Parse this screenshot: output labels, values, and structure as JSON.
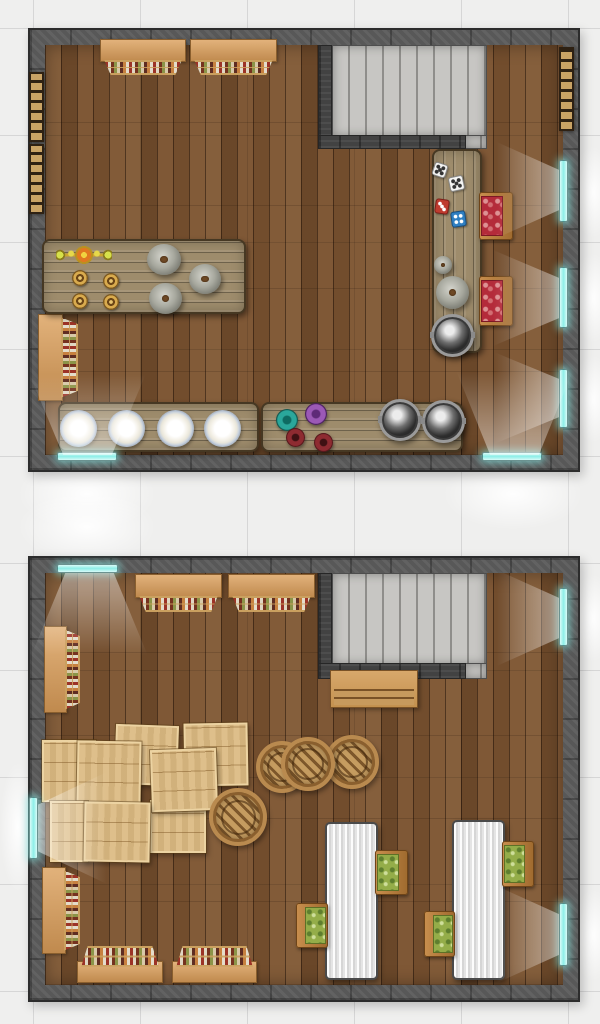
{
  "meta": {
    "canvas_width": 600,
    "canvas_height": 1024,
    "grid_size": 107,
    "grid_offset_x": 33,
    "grid_offset_y": 28
  },
  "palette": {
    "c-bg": "#efefee",
    "c-grid": "#d6d6d6",
    "c-wall": "#585858",
    "c-wall-dark": "#2c2c2c",
    "c-floor": "#7b5330",
    "c-window": "#8deee8",
    "c-wood-light": "#dcba82",
    "c-table-gray": "#9e8c6c",
    "c-table-white": "#e8e8e8",
    "c-cushion-red": "#b42b3a",
    "c-cushion-green": "#94ad49",
    "c-stairs-light": "#c7c6c3",
    "c-stairs-dark": "#8f8e8b"
  },
  "items": [
    {
      "name": "window-glow",
      "type": "glow",
      "x": 18,
      "y": 458,
      "w": 138,
      "h": 72
    },
    {
      "name": "window-glow",
      "type": "glow",
      "x": 443,
      "y": 458,
      "w": 140,
      "h": 72
    },
    {
      "name": "window-glow",
      "type": "glow",
      "x": 572,
      "y": 146,
      "w": 42,
      "h": 92
    },
    {
      "name": "window-glow",
      "type": "glow",
      "x": 572,
      "y": 253,
      "w": 42,
      "h": 90
    },
    {
      "name": "window-glow",
      "type": "glow",
      "x": 572,
      "y": 355,
      "w": 42,
      "h": 88
    },
    {
      "name": "window-glow",
      "type": "glow",
      "x": 18,
      "y": 492,
      "w": 138,
      "h": 70
    },
    {
      "name": "window-glow",
      "type": "glow",
      "x": 0,
      "y": 762,
      "w": 36,
      "h": 130
    },
    {
      "name": "window-glow",
      "type": "glow",
      "x": 572,
      "y": 574,
      "w": 42,
      "h": 88
    },
    {
      "name": "window-glow",
      "type": "glow",
      "x": 572,
      "y": 889,
      "w": 42,
      "h": 92
    },
    {
      "name": "kitchen-room-wall",
      "type": "room",
      "x": 28,
      "y": 28,
      "w": 552,
      "h": 444
    },
    {
      "name": "kitchen-floor",
      "type": "floor",
      "x": 45,
      "y": 45,
      "w": 518,
      "h": 410
    },
    {
      "name": "staircase",
      "type": "stairs",
      "x": 332,
      "y": 45,
      "w": 155,
      "h": 92
    },
    {
      "name": "staircase-landing",
      "type": "stairs",
      "x": 464,
      "y": 135,
      "w": 23,
      "h": 14
    },
    {
      "name": "stairwell-wall",
      "type": "stairwall",
      "x": 318,
      "y": 45,
      "w": 14,
      "h": 104
    },
    {
      "name": "stairwell-wall",
      "type": "stairwall",
      "x": 318,
      "y": 135,
      "w": 148,
      "h": 14
    },
    {
      "name": "hanging-shelf",
      "type": "shelf",
      "v": "o-top",
      "x": 100,
      "y": 39,
      "w": 86,
      "h": 36
    },
    {
      "name": "hanging-shelf",
      "type": "shelf",
      "v": "o-top",
      "x": 190,
      "y": 39,
      "w": 87,
      "h": 36
    },
    {
      "name": "wall-shelf",
      "type": "shelf",
      "v": "o-left",
      "x": 38,
      "y": 314,
      "w": 40,
      "h": 87
    },
    {
      "name": "wall-ladder",
      "type": "ladder",
      "x": 29,
      "y": 72,
      "w": 15,
      "h": 70
    },
    {
      "name": "wall-ladder",
      "type": "ladder",
      "x": 29,
      "y": 144,
      "w": 15,
      "h": 70
    },
    {
      "name": "wall-ladder",
      "type": "ladder",
      "x": 559,
      "y": 47,
      "w": 15,
      "h": 84
    },
    {
      "name": "kitchen-work-table",
      "type": "table-wood",
      "v": "planks-h",
      "x": 42,
      "y": 239,
      "w": 204,
      "h": 75
    },
    {
      "name": "candelabra",
      "type": "candelabra",
      "x": 56,
      "y": 246,
      "w": 56,
      "h": 18
    },
    {
      "name": "goblet",
      "type": "goblet",
      "x": 72,
      "y": 270,
      "w": 16,
      "h": 16
    },
    {
      "name": "goblet",
      "type": "goblet",
      "x": 103,
      "y": 273,
      "w": 16,
      "h": 16
    },
    {
      "name": "goblet",
      "type": "goblet",
      "x": 72,
      "y": 293,
      "w": 16,
      "h": 16
    },
    {
      "name": "goblet",
      "type": "goblet",
      "x": 103,
      "y": 294,
      "w": 16,
      "h": 16
    },
    {
      "name": "stone-dome",
      "type": "dome",
      "x": 147,
      "y": 244,
      "w": 34,
      "h": 31
    },
    {
      "name": "stone-dome",
      "type": "dome",
      "x": 189,
      "y": 264,
      "w": 32,
      "h": 30
    },
    {
      "name": "stone-dome",
      "type": "dome",
      "x": 149,
      "y": 283,
      "w": 33,
      "h": 31
    },
    {
      "name": "prep-table",
      "type": "table-wood",
      "v": "planks-v",
      "x": 432,
      "y": 149,
      "w": 50,
      "h": 204
    },
    {
      "name": "white-die",
      "type": "die",
      "v": "white",
      "x": 433,
      "y": 163,
      "w": 14,
      "h": 14,
      "rot": 18
    },
    {
      "name": "white-die",
      "type": "die",
      "v": "white",
      "x": 449,
      "y": 176,
      "w": 15,
      "h": 15,
      "rot": -12
    },
    {
      "name": "red-die",
      "type": "die",
      "v": "red",
      "x": 435,
      "y": 199,
      "w": 14,
      "h": 15,
      "rot": 8
    },
    {
      "name": "blue-die",
      "type": "die",
      "v": "blue",
      "x": 451,
      "y": 211,
      "w": 15,
      "h": 16,
      "rot": -8
    },
    {
      "name": "small-mortar",
      "type": "dome",
      "x": 434,
      "y": 256,
      "w": 18,
      "h": 18
    },
    {
      "name": "mortar",
      "type": "dome",
      "x": 436,
      "y": 276,
      "w": 33,
      "h": 33
    },
    {
      "name": "cauldron",
      "type": "pot",
      "x": 431,
      "y": 314,
      "w": 43,
      "h": 43
    },
    {
      "name": "chair-red-cushion",
      "type": "chair",
      "v": "face-left red",
      "x": 479,
      "y": 192,
      "w": 34,
      "h": 48
    },
    {
      "name": "chair-red-cushion",
      "type": "chair",
      "v": "face-left red",
      "x": 479,
      "y": 276,
      "w": 34,
      "h": 50
    },
    {
      "name": "plates-table",
      "type": "table-wood",
      "v": "planks-h",
      "x": 58,
      "y": 402,
      "w": 201,
      "h": 50
    },
    {
      "name": "plate",
      "type": "plate",
      "x": 60,
      "y": 410,
      "w": 37,
      "h": 37
    },
    {
      "name": "plate",
      "type": "plate",
      "x": 108,
      "y": 410,
      "w": 37,
      "h": 37
    },
    {
      "name": "plate",
      "type": "plate",
      "x": 157,
      "y": 410,
      "w": 37,
      "h": 37
    },
    {
      "name": "plate",
      "type": "plate",
      "x": 204,
      "y": 410,
      "w": 37,
      "h": 37
    },
    {
      "name": "cooking-table",
      "type": "table-wood",
      "v": "planks-h",
      "x": 261,
      "y": 402,
      "w": 202,
      "h": 50
    },
    {
      "name": "teal-bowl",
      "type": "bowl",
      "v": "teal",
      "x": 276,
      "y": 409,
      "w": 22,
      "h": 22
    },
    {
      "name": "purple-bowl",
      "type": "bowl",
      "v": "purple",
      "x": 305,
      "y": 403,
      "w": 22,
      "h": 22
    },
    {
      "name": "maroon-bowl",
      "type": "bowl",
      "v": "maroon",
      "x": 286,
      "y": 428,
      "w": 19,
      "h": 19
    },
    {
      "name": "maroon-bowl",
      "type": "bowl",
      "v": "maroon",
      "x": 314,
      "y": 433,
      "w": 19,
      "h": 19
    },
    {
      "name": "cooking-pot",
      "type": "pot",
      "x": 379,
      "y": 399,
      "w": 42,
      "h": 42
    },
    {
      "name": "cooking-pot",
      "type": "pot",
      "x": 422,
      "y": 400,
      "w": 43,
      "h": 43
    },
    {
      "name": "window",
      "type": "window",
      "v": "h",
      "x": 57,
      "y": 452,
      "w": 60,
      "h": 9
    },
    {
      "name": "window",
      "type": "window",
      "v": "h",
      "x": 482,
      "y": 452,
      "w": 60,
      "h": 9
    },
    {
      "name": "window",
      "type": "window",
      "v": "v",
      "x": 559,
      "y": 160,
      "w": 9,
      "h": 62
    },
    {
      "name": "window",
      "type": "window",
      "v": "v",
      "x": 559,
      "y": 267,
      "w": 9,
      "h": 61
    },
    {
      "name": "window",
      "type": "window",
      "v": "v",
      "x": 559,
      "y": 369,
      "w": 9,
      "h": 59
    },
    {
      "name": "light-wedge",
      "type": "wedge",
      "v": "up",
      "x": 20,
      "y": 352,
      "w": 135,
      "h": 103
    },
    {
      "name": "light-wedge",
      "type": "wedge",
      "v": "up",
      "x": 447,
      "y": 348,
      "w": 135,
      "h": 107
    },
    {
      "name": "light-wedge",
      "type": "wedge",
      "v": "left",
      "x": 479,
      "y": 134,
      "w": 80,
      "h": 112
    },
    {
      "name": "light-wedge",
      "type": "wedge",
      "v": "left",
      "x": 474,
      "y": 242,
      "w": 85,
      "h": 112
    },
    {
      "name": "light-wedge",
      "type": "wedge",
      "v": "left",
      "x": 477,
      "y": 345,
      "w": 82,
      "h": 106
    },
    {
      "name": "storage-room-wall",
      "type": "room",
      "x": 28,
      "y": 556,
      "w": 552,
      "h": 446
    },
    {
      "name": "storage-floor",
      "type": "floor",
      "x": 45,
      "y": 573,
      "w": 518,
      "h": 412
    },
    {
      "name": "staircase",
      "type": "stairs",
      "x": 332,
      "y": 573,
      "w": 155,
      "h": 92
    },
    {
      "name": "staircase-landing",
      "type": "stairs",
      "x": 464,
      "y": 663,
      "w": 23,
      "h": 16
    },
    {
      "name": "stairwell-wall",
      "type": "stairwall",
      "x": 318,
      "y": 573,
      "w": 14,
      "h": 106
    },
    {
      "name": "stairwell-wall",
      "type": "stairwall",
      "x": 318,
      "y": 663,
      "w": 148,
      "h": 16
    },
    {
      "name": "bench",
      "type": "bench",
      "x": 330,
      "y": 670,
      "w": 88,
      "h": 38
    },
    {
      "name": "hanging-shelf",
      "type": "shelf",
      "v": "o-top",
      "x": 135,
      "y": 574,
      "w": 87,
      "h": 38
    },
    {
      "name": "hanging-shelf",
      "type": "shelf",
      "v": "o-top",
      "x": 228,
      "y": 574,
      "w": 87,
      "h": 38
    },
    {
      "name": "wall-shelf",
      "type": "shelf",
      "v": "o-left",
      "x": 44,
      "y": 626,
      "w": 36,
      "h": 87
    },
    {
      "name": "wall-shelf",
      "type": "shelf",
      "v": "o-left",
      "x": 42,
      "y": 867,
      "w": 38,
      "h": 87
    },
    {
      "name": "wall-shelf",
      "type": "shelf",
      "v": "o-bottom",
      "x": 77,
      "y": 946,
      "w": 86,
      "h": 37
    },
    {
      "name": "wall-shelf",
      "type": "shelf",
      "v": "o-bottom",
      "x": 172,
      "y": 946,
      "w": 85,
      "h": 37
    },
    {
      "name": "crate",
      "type": "crate",
      "x": 115,
      "y": 725,
      "w": 63,
      "h": 60,
      "rot": 2
    },
    {
      "name": "crate",
      "type": "crate",
      "x": 184,
      "y": 723,
      "w": 64,
      "h": 63,
      "rot": -1
    },
    {
      "name": "crate",
      "type": "crate",
      "x": 42,
      "y": 740,
      "w": 54,
      "h": 62
    },
    {
      "name": "crate",
      "type": "crate",
      "x": 150,
      "y": 800,
      "w": 56,
      "h": 53
    },
    {
      "name": "crate",
      "type": "crate",
      "x": 77,
      "y": 741,
      "w": 64,
      "h": 62,
      "rot": 1
    },
    {
      "name": "crate",
      "type": "crate",
      "x": 151,
      "y": 749,
      "w": 66,
      "h": 62,
      "rot": -2
    },
    {
      "name": "crate",
      "type": "crate",
      "x": 50,
      "y": 801,
      "w": 38,
      "h": 61
    },
    {
      "name": "crate",
      "type": "crate",
      "x": 84,
      "y": 802,
      "w": 66,
      "h": 60,
      "rot": 1
    },
    {
      "name": "barrel",
      "type": "barrel",
      "x": 256,
      "y": 741,
      "w": 52,
      "h": 52
    },
    {
      "name": "barrel",
      "type": "barrel",
      "x": 325,
      "y": 735,
      "w": 54,
      "h": 54
    },
    {
      "name": "barrel",
      "type": "barrel",
      "x": 281,
      "y": 737,
      "w": 54,
      "h": 54
    },
    {
      "name": "barrel",
      "type": "barrel",
      "x": 209,
      "y": 788,
      "w": 58,
      "h": 58
    },
    {
      "name": "dining-table",
      "type": "table-white",
      "x": 325,
      "y": 822,
      "w": 53,
      "h": 158
    },
    {
      "name": "dining-table",
      "type": "table-white",
      "x": 452,
      "y": 820,
      "w": 53,
      "h": 160
    },
    {
      "name": "chair-green-cushion",
      "type": "chair",
      "v": "face-left green",
      "x": 375,
      "y": 850,
      "w": 33,
      "h": 45
    },
    {
      "name": "chair-green-cushion",
      "type": "chair",
      "v": "face-right green",
      "x": 296,
      "y": 903,
      "w": 32,
      "h": 45
    },
    {
      "name": "chair-green-cushion",
      "type": "chair",
      "v": "face-left green",
      "x": 502,
      "y": 841,
      "w": 32,
      "h": 46
    },
    {
      "name": "chair-green-cushion",
      "type": "chair",
      "v": "face-right green",
      "x": 424,
      "y": 911,
      "w": 31,
      "h": 46
    },
    {
      "name": "window",
      "type": "window",
      "v": "h",
      "x": 57,
      "y": 564,
      "w": 61,
      "h": 9
    },
    {
      "name": "window",
      "type": "window",
      "v": "v",
      "x": 29,
      "y": 797,
      "w": 9,
      "h": 62
    },
    {
      "name": "window",
      "type": "window",
      "v": "v",
      "x": 559,
      "y": 588,
      "w": 9,
      "h": 58
    },
    {
      "name": "window",
      "type": "window",
      "v": "v",
      "x": 559,
      "y": 903,
      "w": 9,
      "h": 63
    },
    {
      "name": "light-wedge",
      "type": "wedge",
      "v": "down",
      "x": 22,
      "y": 573,
      "w": 135,
      "h": 105
    },
    {
      "name": "light-wedge",
      "type": "wedge",
      "v": "right",
      "x": 38,
      "y": 763,
      "w": 88,
      "h": 130
    },
    {
      "name": "light-wedge",
      "type": "wedge",
      "v": "left",
      "x": 479,
      "y": 562,
      "w": 80,
      "h": 112
    },
    {
      "name": "light-wedge",
      "type": "wedge",
      "v": "left",
      "x": 479,
      "y": 878,
      "w": 80,
      "h": 113
    }
  ]
}
